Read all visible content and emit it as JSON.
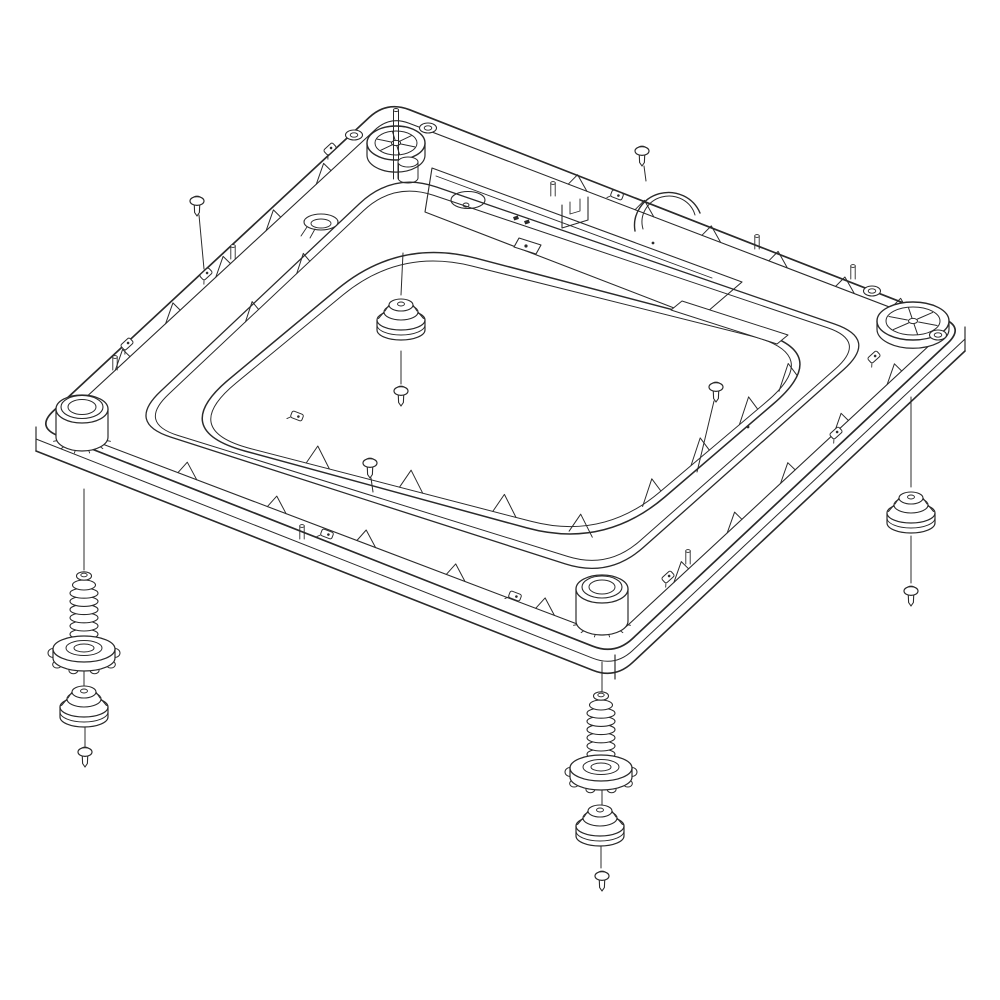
{
  "meta": {
    "title": "Washer base exploded-view parts diagram",
    "background": "#ffffff",
    "ink": "#2b2b2b",
    "canvas": {
      "w": 1000,
      "h": 1000
    }
  },
  "base": {
    "outlines": [
      {
        "name": "base-outer-edge",
        "corners": [
          [
            387,
            101
          ],
          [
            965,
            327
          ],
          [
            615,
            655
          ],
          [
            36,
            427
          ]
        ],
        "r": 24,
        "sw": 1.7
      },
      {
        "name": "base-rim-inner-edge",
        "corners": [
          [
            390,
            116
          ],
          [
            947,
            329
          ],
          [
            614,
            638
          ],
          [
            55,
            426
          ]
        ],
        "r": 20,
        "sw": 1.1
      },
      {
        "name": "channel-outer-wall-top",
        "corners": [
          [
            393,
            172
          ],
          [
            878,
            339
          ],
          [
            609,
            578
          ],
          [
            127,
            423
          ]
        ],
        "r": 46,
        "sw": 1.3
      },
      {
        "name": "channel-outer-wall-base",
        "corners": [
          [
            394,
            182
          ],
          [
            867,
            341
          ],
          [
            608,
            569
          ],
          [
            138,
            423
          ]
        ],
        "r": 42,
        "sw": 1.0
      },
      {
        "name": "center-panel-edge",
        "corners": [
          [
            399,
            238
          ],
          [
            834,
            352
          ],
          [
            604,
            549
          ],
          [
            168,
            430
          ]
        ],
        "r": 80,
        "sw": 1.5
      },
      {
        "name": "center-panel-inner-line",
        "corners": [
          [
            400,
            248
          ],
          [
            823,
            354
          ],
          [
            603,
            540
          ],
          [
            179,
            430
          ]
        ],
        "r": 74,
        "sw": 1.0
      }
    ],
    "thickness": {
      "left": [
        36,
        427
      ],
      "bottom": [
        615,
        655
      ],
      "right": [
        965,
        327
      ],
      "offsets": [
        12,
        24
      ],
      "r": 24
    },
    "rib_rows": [
      {
        "name": "rim-ribs-upper-left",
        "from": [
          55,
          426
        ],
        "to": [
          390,
          116
        ],
        "ts": [
          0.18,
          0.33,
          0.48,
          0.63,
          0.78
        ],
        "w": 20,
        "h": 14
      },
      {
        "name": "rim-ribs-upper-right",
        "from": [
          390,
          116
        ],
        "to": [
          947,
          329
        ],
        "ts": [
          0.32,
          0.44,
          0.56,
          0.68,
          0.8,
          0.9
        ],
        "w": 20,
        "h": 13
      },
      {
        "name": "rim-ribs-lower-right",
        "from": [
          614,
          638
        ],
        "to": [
          947,
          329
        ],
        "ts": [
          0.18,
          0.34,
          0.5,
          0.66,
          0.82
        ],
        "w": 20,
        "h": 14
      },
      {
        "name": "rim-ribs-lower-left",
        "from": [
          55,
          426
        ],
        "to": [
          614,
          638
        ],
        "ts": [
          0.22,
          0.38,
          0.54,
          0.7,
          0.86
        ],
        "w": 20,
        "h": 14
      },
      {
        "name": "moat-gussets-lower-left",
        "from": [
          179,
          430
        ],
        "to": [
          603,
          540
        ],
        "ts": [
          0.3,
          0.52,
          0.74,
          0.92
        ],
        "w": 24,
        "h": 20
      },
      {
        "name": "moat-gussets-lower-right",
        "from": [
          603,
          540
        ],
        "to": [
          823,
          354
        ],
        "ts": [
          0.18,
          0.4,
          0.62,
          0.8
        ],
        "w": 24,
        "h": 20
      },
      {
        "name": "moat-gussets-upper-left",
        "from": [
          138,
          423
        ],
        "to": [
          394,
          182
        ],
        "ts": [
          0.42,
          0.62
        ],
        "w": 18,
        "h": 14
      }
    ],
    "pins": [
      [
        233,
        246
      ],
      [
        115,
        357
      ],
      [
        553,
        183
      ],
      [
        757,
        236
      ],
      [
        853,
        266
      ],
      [
        688,
        551
      ],
      [
        302,
        526
      ]
    ],
    "clips": [
      [
        330,
        149,
        -43
      ],
      [
        206,
        274,
        -43
      ],
      [
        127,
        344,
        -43
      ],
      [
        617,
        195,
        21
      ],
      [
        836,
        433,
        -42
      ],
      [
        874,
        357,
        -42
      ],
      [
        668,
        577,
        -42
      ],
      [
        297,
        416,
        21
      ],
      [
        327,
        534,
        21
      ],
      [
        515,
        596,
        21
      ]
    ],
    "dots": [
      [
        653,
        243
      ],
      [
        748,
        427
      ]
    ],
    "platform": {
      "outer": [
        [
          432,
          168
        ],
        [
          742,
          282
        ],
        [
          700,
          318
        ],
        [
          425,
          212
        ]
      ],
      "inner_line": [
        [
          436,
          176
        ],
        [
          712,
          278
        ]
      ]
    },
    "recess": {
      "cx": 468,
      "cy": 200,
      "rx": 17,
      "ry": 8.5,
      "hole_cx": 466,
      "hole_cy": 205,
      "hole_rx": 3,
      "hole_ry": 2
    },
    "cup": {
      "cx": 321,
      "cy": 222,
      "rx": 17,
      "ry": 8,
      "irx": 10,
      "iry": 4.5
    },
    "bracket": {
      "outer": [
        [
          519,
          238
        ],
        [
          541,
          245
        ],
        [
          536,
          254
        ],
        [
          514,
          247
        ]
      ],
      "dot": [
        526,
        246
      ]
    },
    "u_bracket": {
      "outer": [
        [
          562,
          205
        ],
        [
          562,
          228
        ],
        [
          588,
          220
        ],
        [
          588,
          197
        ]
      ],
      "inner": [
        [
          570,
          202
        ],
        [
          570,
          214
        ],
        [
          580,
          211
        ],
        [
          580,
          199
        ]
      ]
    },
    "minibits": [
      [
        516,
        218
      ],
      [
        527,
        222
      ]
    ],
    "slot": [
      [
        682,
        301
      ],
      [
        788,
        335
      ],
      [
        777,
        344
      ],
      [
        671,
        310
      ]
    ],
    "dome": {
      "x1": 635,
      "y1": 231,
      "x2": 700,
      "y2": 213,
      "rox": 34,
      "roy": 33,
      "rix": 26,
      "riy": 25
    },
    "mounts": {
      "top_wheel": {
        "cx": 396,
        "cy": 143,
        "rx": 29,
        "ry": 17,
        "irx": 21,
        "iry": 12,
        "depth": 22,
        "pin": true,
        "ears": [
          [
            354,
            135
          ],
          [
            428,
            128
          ]
        ]
      },
      "right_wheel": {
        "cx": 913,
        "cy": 321,
        "rx": 36,
        "ry": 19,
        "irx": 27,
        "iry": 14,
        "depth": 15,
        "pin": false,
        "ears": [
          [
            872,
            291
          ],
          [
            938,
            335
          ]
        ]
      },
      "left_boss": {
        "cx": 82,
        "cy": 409,
        "rx": 26,
        "ry": 14,
        "trx": 21,
        "tryy": 11.5,
        "irx": 14,
        "iry": 7.5,
        "depth": 28
      },
      "bottom_boss": {
        "cx": 602,
        "cy": 589,
        "rx": 26,
        "ry": 14,
        "trx": 20,
        "tryy": 11,
        "irx": 13,
        "iry": 7,
        "depth": 32
      },
      "aux_cyl": {
        "cx": 408,
        "cy": 162,
        "rx": 10,
        "ry": 5,
        "depth": 16
      }
    }
  },
  "exploded": {
    "leader_lines": [
      {
        "name": "leader-left-corner-to-spring",
        "x1": 84,
        "y1": 489,
        "x2": 84,
        "y2": 570
      },
      {
        "name": "leader-left-nut-to-foot",
        "x1": 84,
        "y1": 666,
        "x2": 84,
        "y2": 687
      },
      {
        "name": "leader-left-foot-to-screw",
        "x1": 85,
        "y1": 727,
        "x2": 85,
        "y2": 747
      },
      {
        "name": "leader-bottom-corner-to-spring",
        "x1": 602,
        "y1": 662,
        "x2": 602,
        "y2": 694
      },
      {
        "name": "leader-bottom-nut-to-foot",
        "x1": 602,
        "y1": 786,
        "x2": 602,
        "y2": 806
      },
      {
        "name": "leader-bottom-foot-to-screw",
        "x1": 601,
        "y1": 844,
        "x2": 601,
        "y2": 868
      },
      {
        "name": "leader-right-corner-to-foot",
        "x1": 911,
        "y1": 397,
        "x2": 911,
        "y2": 487
      },
      {
        "name": "leader-right-foot-to-screw",
        "x1": 911,
        "y1": 536,
        "x2": 911,
        "y2": 583
      },
      {
        "name": "leader-center-panel-to-foot",
        "x1": 403,
        "y1": 253,
        "x2": 401,
        "y2": 295
      },
      {
        "name": "leader-center-foot-to-screw",
        "x1": 401,
        "y1": 351,
        "x2": 401,
        "y2": 384
      },
      {
        "name": "leader-screw-top-left",
        "x1": 199,
        "y1": 215,
        "x2": 204,
        "y2": 269
      },
      {
        "name": "leader-screw-top-right",
        "x1": 644,
        "y1": 166,
        "x2": 646,
        "y2": 181
      },
      {
        "name": "leader-screw-right-middle",
        "x1": 714,
        "y1": 401,
        "x2": 697,
        "y2": 472
      },
      {
        "name": "leader-screw-left-middle",
        "x1": 371,
        "y1": 478,
        "x2": 373,
        "y2": 492
      }
    ],
    "springs": [
      {
        "name": "leveling-leg-spring-left",
        "x": 84,
        "top": 576,
        "coils": 8,
        "rx": 14,
        "dy": 8.2
      },
      {
        "name": "leveling-leg-spring-bottom",
        "x": 601,
        "top": 696,
        "coils": 8,
        "rx": 14,
        "dy": 8.2
      }
    ],
    "nuts": [
      {
        "name": "leveling-leg-nut-left",
        "x": 84,
        "y": 649
      },
      {
        "name": "leveling-leg-nut-bottom",
        "x": 601,
        "y": 768
      }
    ],
    "feet": [
      {
        "name": "foot-pad-center",
        "x": 401,
        "y": 318
      },
      {
        "name": "foot-pad-right",
        "x": 911,
        "y": 511
      },
      {
        "name": "foot-pad-left",
        "x": 84,
        "y": 705
      },
      {
        "name": "foot-pad-bottom",
        "x": 600,
        "y": 824
      }
    ],
    "screws": [
      {
        "name": "screw-top-left",
        "x": 197,
        "y": 201
      },
      {
        "name": "screw-top-right",
        "x": 642,
        "y": 151
      },
      {
        "name": "screw-right-middle",
        "x": 716,
        "y": 387
      },
      {
        "name": "screw-left-middle",
        "x": 370,
        "y": 463
      },
      {
        "name": "screw-left-foot",
        "x": 85,
        "y": 752
      },
      {
        "name": "screw-bottom-foot",
        "x": 602,
        "y": 876
      },
      {
        "name": "screw-right-foot",
        "x": 911,
        "y": 591
      },
      {
        "name": "screw-center-foot",
        "x": 401,
        "y": 391
      }
    ]
  }
}
